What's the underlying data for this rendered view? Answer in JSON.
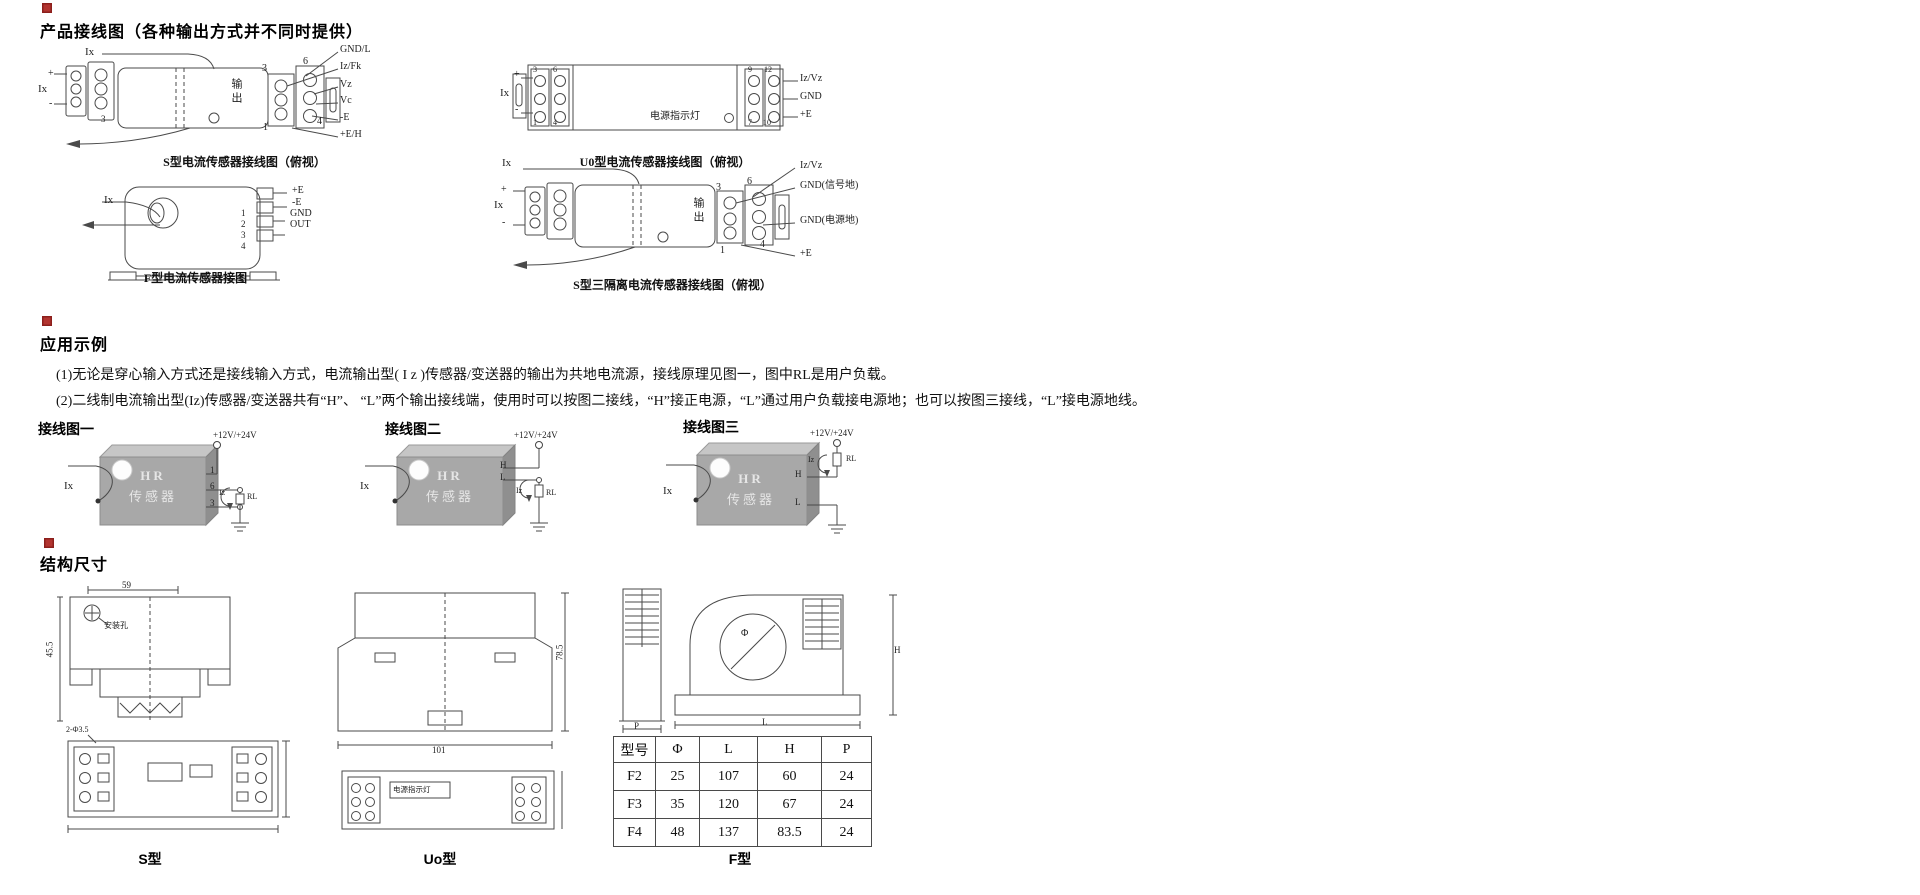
{
  "sections": {
    "wiring": {
      "title": "产品接线图（各种输出方式并不同时提供）",
      "s_type": {
        "ix_top": "Ix",
        "plus": "+",
        "ix": "Ix",
        "minus": "-",
        "pin_3b": "3",
        "output": "输出",
        "pin3": "3",
        "pin6": "6",
        "pin1": "1",
        "pin4": "4",
        "labels": [
          "GND/L",
          "Iz/Fk",
          "Vz",
          "Vc",
          "-E",
          "+E/H"
        ],
        "caption": "S型电流传感器接线图（俯视）"
      },
      "f_type": {
        "ix": "Ix",
        "labels": [
          "+E",
          "-E",
          "GND",
          "OUT"
        ],
        "pins": [
          "1",
          "2",
          "3",
          "4"
        ],
        "caption": "F型电流传感器接图"
      },
      "u0_type": {
        "ix": "Ix",
        "plus": "+",
        "minus": "-",
        "led": "电源指示灯",
        "pin_tl": "3",
        "pin_tr": "6",
        "pin_bl": "1",
        "pin_br": "4",
        "pin9": "9",
        "pin12": "12",
        "pin7": "7",
        "pin10": "10",
        "labels": [
          "Iz/Vz",
          "GND",
          "+E"
        ],
        "caption": "U0型电流传感器接线图（俯视）"
      },
      "s3_type": {
        "ix_top": "Ix",
        "plus": "+",
        "ix": "Ix",
        "minus": "-",
        "output": "输出",
        "pin3": "3",
        "pin6": "6",
        "pin1": "1",
        "pin4": "4",
        "labels": [
          "Iz/Vz",
          "GND(信号地)",
          "GND(电源地)",
          "+E"
        ],
        "caption": "S型三隔离电流传感器接线图（俯视）"
      }
    },
    "application": {
      "title": "应用示例",
      "para1": "(1)无论是穿心输入方式还是接线输入方式，电流输出型( I z )传感器/变送器的输出为共地电流源，接线原理见图一，图中RL是用户负载。",
      "para2": "(2)二线制电流输出型(Iz)传感器/变送器共有“H”、 “L”两个输出接线端，使用时可以按图二接线，“H”接正电源，“L”通过用户负载接电源地；也可以按图三接线，“L”接电源地线。",
      "figs": [
        {
          "label": "接线图一",
          "power": "+12V/+24V",
          "hr": "HR",
          "sensor": "传感器",
          "ix": "Ix",
          "pa": "1",
          "pb": "6",
          "pc": "3",
          "iz": "Iz",
          "rl": "RL"
        },
        {
          "label": "接线图二",
          "power": "+12V/+24V",
          "hr": "HR",
          "sensor": "传感器",
          "ix": "Ix",
          "pa": "H",
          "pb": "L",
          "iz": "Iz",
          "rl": "RL"
        },
        {
          "label": "接线图三",
          "power": "+12V/+24V",
          "hr": "HR",
          "sensor": "传感器",
          "ix": "Ix",
          "pa": "H",
          "pb": "L",
          "iz": "Iz",
          "rl": "RL"
        }
      ]
    },
    "dimensions": {
      "title": "结构尺寸",
      "s": {
        "dim_top": "59",
        "dim_left": "45.5",
        "hole_note": "安装孔",
        "bottom_note": "2-Φ3.5",
        "caption": "S型"
      },
      "uo": {
        "dim_right": "78.5",
        "dim_bottom": "101",
        "led": "电源指示灯",
        "caption": "Uo型"
      },
      "f": {
        "phi": "Φ",
        "h": "H",
        "l": "L",
        "p": "P",
        "caption": "F型"
      },
      "table": {
        "headers": [
          "型号",
          "Φ",
          "L",
          "H",
          "P"
        ],
        "rows": [
          [
            "F2",
            "25",
            "107",
            "60",
            "24"
          ],
          [
            "F3",
            "35",
            "120",
            "67",
            "24"
          ],
          [
            "F4",
            "48",
            "137",
            "83.5",
            "24"
          ]
        ]
      }
    }
  }
}
